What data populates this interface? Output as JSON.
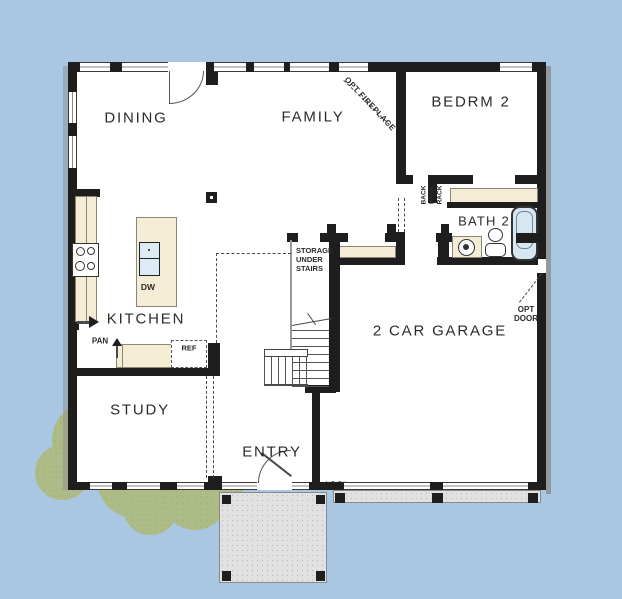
{
  "plan": {
    "rooms": {
      "dining": "DINING",
      "family": "FAMILY",
      "bedrm2": "BEDRM 2",
      "bath2": "BATH 2",
      "kitchen": "KITCHEN",
      "study": "STUDY",
      "entry": "ENTRY",
      "garage": "2 CAR GARAGE"
    },
    "annotations": {
      "opt_fireplace": "OPT FIREPLACE",
      "storage1": "STORAGE",
      "storage2": "UNDER",
      "storage3": "STAIRS",
      "back": "BACK",
      "pack": "PACK",
      "rack": "RACK",
      "opt_door1": "OPT",
      "opt_door2": "DOOR",
      "pantry": "PAN",
      "refrigerator": "REF",
      "dishwasher": "DW"
    },
    "colors": {
      "background": "#a9c7e2",
      "wall": "#1e1e1e",
      "floor": "#ffffff",
      "counter": "#f4ecd4",
      "fixture_blue": "#d7e7f2",
      "concrete": "#e1e1e1",
      "shrub": "#adbb87",
      "text": "#2d2a28"
    }
  }
}
